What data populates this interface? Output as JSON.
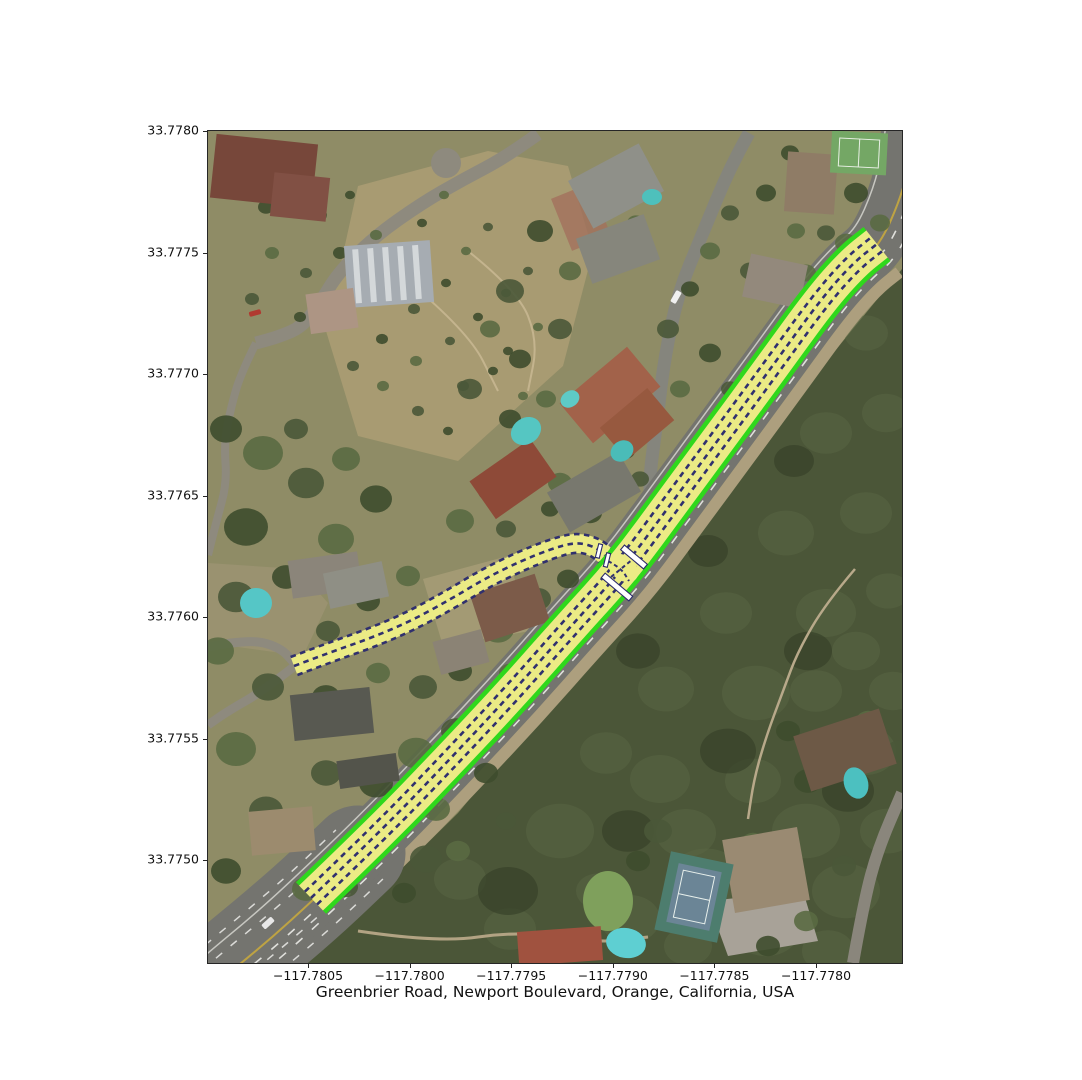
{
  "figure": {
    "title": "Greenbrier Road, Newport Boulevard, Orange, California, USA"
  },
  "axes": {
    "x": {
      "tick_labels": [
        "−117.7805",
        "−117.7800",
        "−117.7795",
        "−117.7790",
        "−117.7785",
        "−117.7780"
      ]
    },
    "y": {
      "tick_labels": [
        "33.7780",
        "33.7775",
        "33.7770",
        "33.7765",
        "33.7760",
        "33.7755",
        "33.7750"
      ]
    }
  },
  "map": {
    "type": "satellite-imagery-with-lane-overlay",
    "place": "Greenbrier Road, Newport Boulevard, Orange, California, USA",
    "colors": {
      "lane_fill": "#ebeb85",
      "lane_divider": "#30306e",
      "road_edge": "#2fd81c",
      "stop_bar": "#ffffff",
      "stop_bar_outline": "#2b2b6b"
    },
    "roads": [
      {
        "name": "Newport Boulevard",
        "lanes": 4,
        "has_edge_lines": true
      },
      {
        "name": "Greenbrier Road",
        "lanes": 2,
        "has_edge_lines": false
      }
    ]
  },
  "chart_data": {
    "type": "map",
    "title": "Greenbrier Road, Newport Boulevard, Orange, California, USA",
    "x_ticks": [
      -117.7805,
      -117.78,
      -117.7795,
      -117.779,
      -117.7785,
      -117.778
    ],
    "y_ticks": [
      33.778,
      33.7775,
      33.777,
      33.7765,
      33.776,
      33.7755,
      33.775
    ],
    "extent": {
      "lon_min": -117.78099,
      "lon_max": -117.77758,
      "lat_min": 33.77458,
      "lat_max": 33.778
    },
    "grid": false,
    "legend": false,
    "overlay": "lane-level road network (4-lane Newport Boulevard, 2-lane Greenbrier Road) with green edge lines, yellow lanes, dashed navy dividers and white stop bars at their intersection"
  }
}
